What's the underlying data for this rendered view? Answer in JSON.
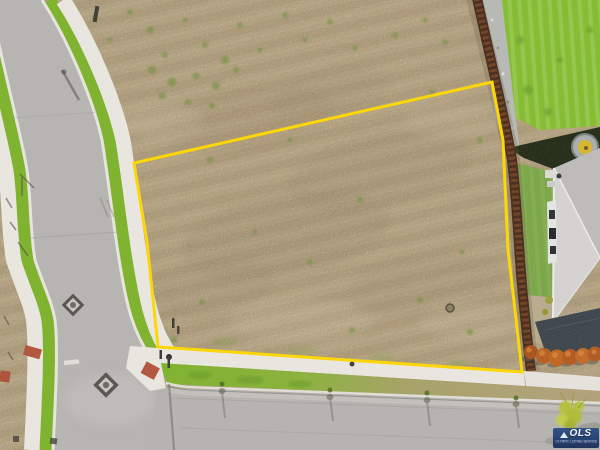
{
  "image": {
    "type": "aerial-drone-photo",
    "subject": "vacant residential lot outlined in yellow at a street corner"
  },
  "watermark": {
    "abbr": "OLS",
    "name": "OLYMPIC LISTING SERVICE"
  },
  "boundary": {
    "points": "134,163 492,82 503,140 508,250 515,310 522,372 158,347 147,242",
    "color": "#ffd800"
  },
  "palette": {
    "dirt": "#b3a07b",
    "asphalt": "#b6b5b2",
    "sidewalk": "#ebe8e1",
    "parkway_grass": "#7db32a",
    "neighbor_lawn": "#83bd2f",
    "fence_brown": "#53321e",
    "boundary_yellow": "#ffd800",
    "roof_gray": "#cfcecc",
    "dark_roof": "#3c444b",
    "shrub_orange": "#b65e22",
    "hedge_shadow": "#222b16",
    "ada_ramp_red": "#b2543c",
    "watermark_blue": "#1d3a70"
  },
  "scene": {
    "elements": [
      "tilled dirt lot",
      "yellow property boundary",
      "curved street with grass parkways and sidewalks",
      "bottom street with young street trees",
      "wood privacy fence",
      "neighbor lawn, hedge and gray-roof house",
      "row of orange shrubs",
      "utility diamond markers",
      "listing-service watermark"
    ]
  }
}
